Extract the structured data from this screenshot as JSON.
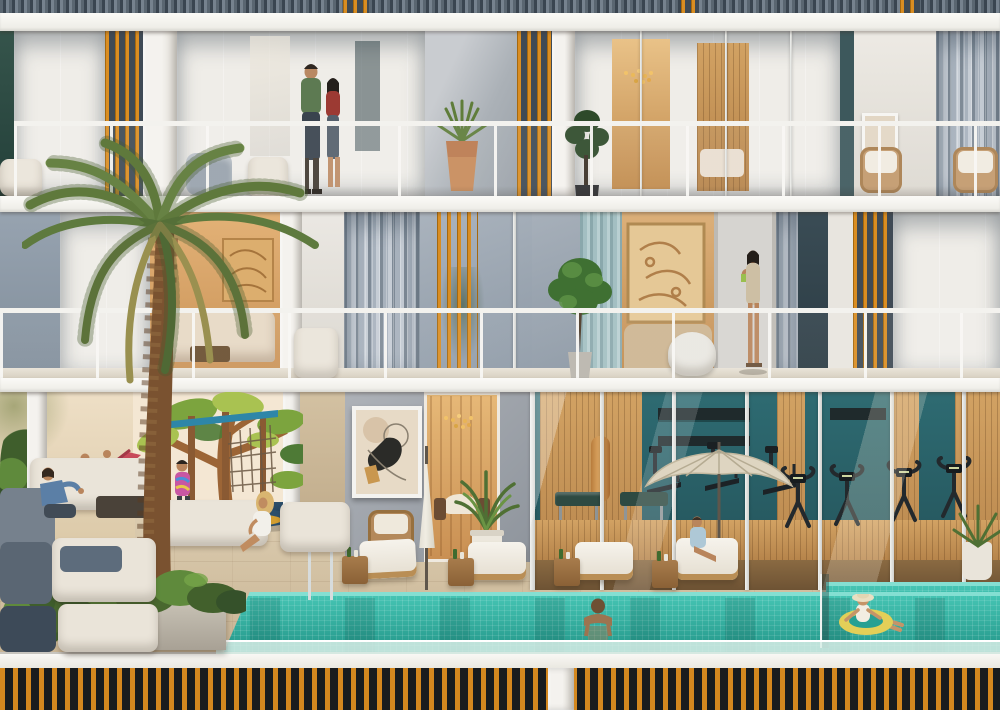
{
  "title": "Residential building cross-section rendering with amenities",
  "palette": {
    "facade": "#efede8",
    "slab": "#f8f7f3",
    "curtain": "#a8b2bd",
    "curtainLight": "#c6cdd5",
    "curtainDark": "#7e8a96",
    "glassDark": "#55626e",
    "orange": "#d98d22",
    "orangeDark": "#a5680f",
    "edgeGreen": "#2c4a42",
    "warm": "#d8a768",
    "warmDeep": "#c08a4c",
    "glow": "#f0c27c",
    "wood": "#c6975a",
    "gymTeal": "#2e6b72",
    "gymTealDark": "#235158",
    "water": "#45c4b3",
    "waterDeep": "#219386",
    "waterEdge": "#84dfd2",
    "deck": "#e2d3ba",
    "deckDark": "#c6b194",
    "muralBg": "#f4e7d3",
    "green1": "#7ca43e",
    "green2": "#a9c251",
    "green3": "#4e7a36",
    "trunk": "#9c6536",
    "slideRed": "#c8495a",
    "playBlue": "#2e86a8",
    "matNavy": "#2c4f6b",
    "matYellow": "#dda32d",
    "fenceBlack": "#191c1e",
    "fenceOrange": "#d4881f",
    "rail": "#f3f2ee",
    "palmGreen": "#6d8a45",
    "palmDark": "#55713a",
    "palmDry": "#99904f",
    "palmTrunk": "#7a5230",
    "palmTrunkDark": "#5a3a20",
    "pot": "#c78b5a",
    "planter": "#b7b0a3",
    "bush": "#3f5e2c",
    "bushLight": "#5f8a3c",
    "sofaWhite": "#eae4d9",
    "sofaGray": "#76818d",
    "navyCushion": "#5d6c7c",
    "artBg": "#e7dac6",
    "skin": "#bb8a62",
    "machine": "#23292d",
    "benchPad": "#2e4a42"
  },
  "scene": {
    "type": "3D architectural rendering, elevation cut-away",
    "floors": [
      {
        "name": "floor-3",
        "features": [
          "glass-balustrade",
          "gray-sheer-curtains",
          "orange-louver-screens",
          "couple-standing-on-balcony",
          "terracotta-planter-with-agave",
          "chandelier-living-room",
          "wood-slat-bedroom",
          "framed-artwork",
          "rattan-armchairs",
          "fiddle-leaf-plant"
        ]
      },
      {
        "name": "floor-2",
        "features": [
          "palm-tree-crown",
          "warm-living-room-with-sofa",
          "orange-louver-screens",
          "white-armchair",
          "potted-tree-on-balcony",
          "teal-curtain",
          "relief-art-lounge",
          "white-pouf",
          "woman-drinking-on-balcony",
          "glass-balustrade"
        ]
      },
      {
        "name": "ground-floor",
        "features": [
          "outdoor-lounge-sofas",
          "man-sitting",
          "woman-sitting",
          "kids-playground",
          "tree-mural",
          "red-slide",
          "climbing-frame-with-net",
          "three-children-playing",
          "palm-tree-trunk",
          "abstract-wall-art",
          "closed-patio-umbrella",
          "rattan-chair",
          "warm-lobby-doorway",
          "potted-plants",
          "glass-walled-gym",
          "punching-bag",
          "workout-benches",
          "cardio-machines",
          "open-patio-umbrella",
          "woman-on-sun-lounger",
          "sun-loungers",
          "drink-tables",
          "pool-ladder",
          "infinity-pool",
          "man-swimming",
          "girl-on-yellow-float",
          "concrete-planter-with-shrubs"
        ]
      }
    ],
    "base": {
      "features": [
        "white-plinth-band",
        "orange-slat-fence",
        "white-fence-pillar"
      ]
    }
  }
}
